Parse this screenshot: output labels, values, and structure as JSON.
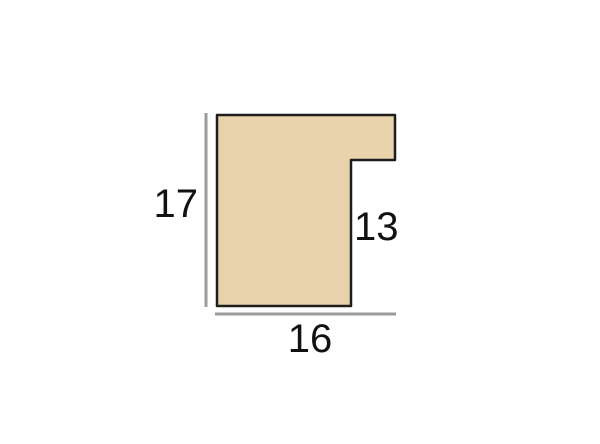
{
  "diagram": {
    "profile_fill": "#e9d3ad",
    "profile_outline": "#1d1d1b",
    "dim_line_color": "#9c9c9c",
    "text_color": "#111111",
    "dimensions": {
      "left_height": "17",
      "bottom_width": "16",
      "rebate_height": "13"
    }
  }
}
